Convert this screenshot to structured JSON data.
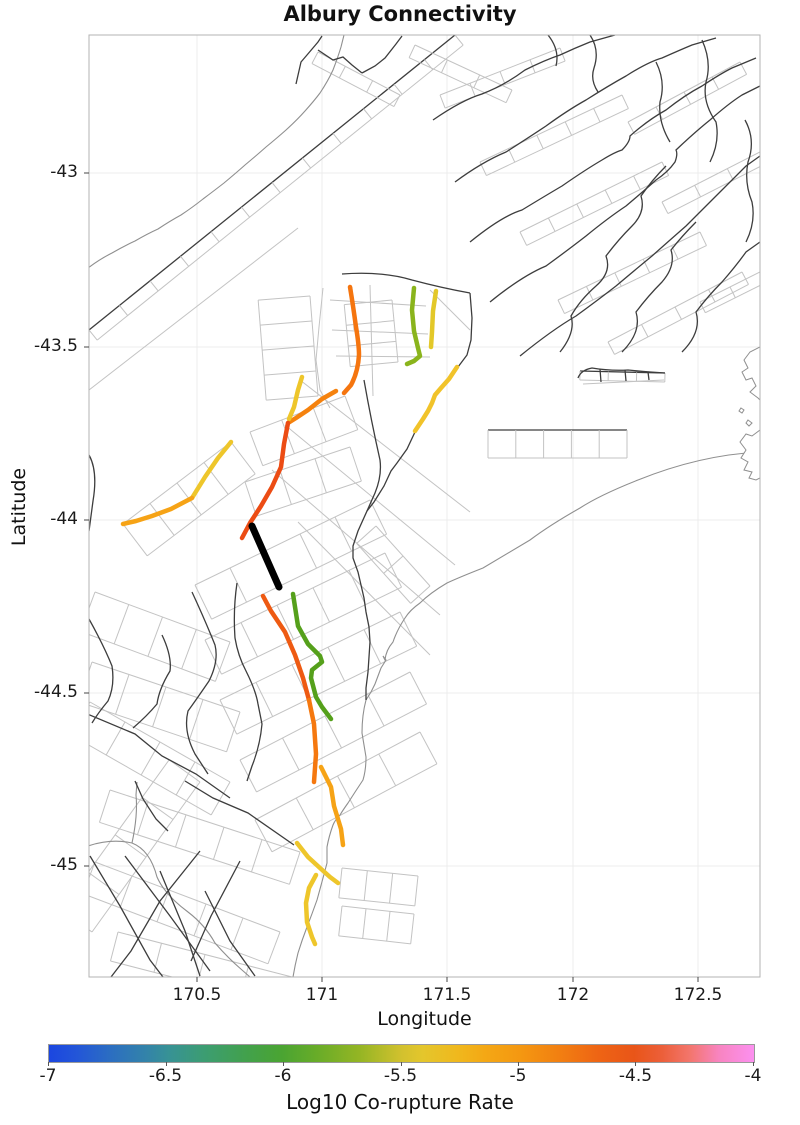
{
  "title": "Albury Connectivity",
  "axes": {
    "xlabel": "Longitude",
    "ylabel": "Latitude",
    "x_ticks": [
      {
        "label": "170.5",
        "px": 197
      },
      {
        "label": "171",
        "px": 322
      },
      {
        "label": "171.5",
        "px": 447
      },
      {
        "label": "172",
        "px": 573
      },
      {
        "label": "172.5",
        "px": 698
      }
    ],
    "y_ticks": [
      {
        "label": "-43",
        "px": 173
      },
      {
        "label": "-43.5",
        "px": 347
      },
      {
        "label": "-44",
        "px": 520
      },
      {
        "label": "-44.5",
        "px": 693
      },
      {
        "label": "-45",
        "px": 866
      }
    ],
    "plot_rect": {
      "x": 89,
      "y": 35,
      "w": 671,
      "h": 942
    }
  },
  "colorbar": {
    "label": "Log10 Co-rupture Rate",
    "min": -7,
    "max": -4,
    "ticks": [
      {
        "label": "-7",
        "frac": 0
      },
      {
        "label": "-6.5",
        "frac": 0.1667
      },
      {
        "label": "-6",
        "frac": 0.3333
      },
      {
        "label": "-5.5",
        "frac": 0.5
      },
      {
        "label": "-5",
        "frac": 0.6667
      },
      {
        "label": "-4.5",
        "frac": 0.8333
      },
      {
        "label": "-4",
        "frac": 1
      }
    ],
    "stops": [
      [
        "0%",
        "#1b46e0"
      ],
      [
        "4%",
        "#2356d8"
      ],
      [
        "9%",
        "#2c6fc0"
      ],
      [
        "14%",
        "#3384a8"
      ],
      [
        "17%",
        "#379295"
      ],
      [
        "22%",
        "#3c9d72"
      ],
      [
        "28%",
        "#42a14c"
      ],
      [
        "33%",
        "#4aa432"
      ],
      [
        "38%",
        "#68ac28"
      ],
      [
        "44%",
        "#94b524"
      ],
      [
        "50%",
        "#d2c12e"
      ],
      [
        "53%",
        "#e4c62c"
      ],
      [
        "58%",
        "#f0b81d"
      ],
      [
        "62%",
        "#f4a714"
      ],
      [
        "67%",
        "#f49711"
      ],
      [
        "72%",
        "#f28111"
      ],
      [
        "78%",
        "#ee6414"
      ],
      [
        "83%",
        "#e95518"
      ],
      [
        "87%",
        "#ec5f3a"
      ],
      [
        "91%",
        "#f3766e"
      ],
      [
        "95%",
        "#f884c0"
      ],
      [
        "100%",
        "#fc90f0"
      ]
    ]
  },
  "chart_data": {
    "type": "line",
    "subtype": "geographic fault-network map",
    "title": "Albury Connectivity",
    "xlabel": "Longitude",
    "ylabel": "Latitude",
    "xlim": [
      170.07,
      172.74
    ],
    "ylim": [
      -45.31,
      -42.6
    ],
    "x_ticks": [
      170.5,
      171,
      171.5,
      172,
      172.5
    ],
    "y_ticks": [
      -43,
      -43.5,
      -44,
      -44.5,
      -45
    ],
    "grid": true,
    "colorbar": {
      "label": "Log10 Co-rupture Rate",
      "range": [
        -7,
        -4
      ],
      "ticks": [
        -7,
        -6.5,
        -6,
        -5.5,
        -5,
        -4.5,
        -4
      ]
    },
    "legend_position": "bottom",
    "background_layers": [
      "grey fault surface-projection polygons",
      "dark fault traces",
      "coastline"
    ],
    "highlighted_faults": [
      {
        "segment": "north-central trace",
        "color": "#f5750f",
        "log10_rate": -4.8
      },
      {
        "segment": "northwest yellow branch",
        "color": "#eec62b",
        "log10_rate": -5.5
      },
      {
        "segment": "west arc yellow part",
        "color": "#eec62b",
        "log10_rate": -5.5
      },
      {
        "segment": "west arc amber part",
        "color": "#f6a316",
        "log10_rate": -5.2
      },
      {
        "segment": "central red-orange trace",
        "color": "#ec4c14",
        "log10_rate": -4.5
      },
      {
        "segment": "upper green branch",
        "color": "#8ab41c",
        "log10_rate": -5.9
      },
      {
        "segment": "upper yellow branch",
        "color": "#e3c829",
        "log10_rate": -5.6
      },
      {
        "segment": "east yellow branch",
        "color": "#f1c32a",
        "log10_rate": -5.4
      },
      {
        "segment": "source fault (thick black)",
        "color": "#000000",
        "log10_rate": null
      },
      {
        "segment": "lower red-orange trace",
        "color": "#ee5a12",
        "log10_rate": -4.7
      },
      {
        "segment": "lower orange trace",
        "color": "#f5780f",
        "log10_rate": -4.9
      },
      {
        "segment": "lower amber trace",
        "color": "#f6a316",
        "log10_rate": -5.2
      },
      {
        "segment": "lower green zigzag",
        "color": "#55a01b",
        "log10_rate": -6.0
      },
      {
        "segment": "south yellow segments",
        "color": "#eec62b",
        "log10_rate": -5.5
      }
    ]
  },
  "map_layers": {
    "ladders": [
      {
        "x1": 89,
        "y1": 330,
        "x2": 455,
        "y2": 35,
        "w": 13,
        "n": 12,
        "main": "dark"
      },
      {
        "x1": 318,
        "y1": 52,
        "x2": 400,
        "y2": 95,
        "w": 13,
        "n": 3,
        "main": "gray"
      },
      {
        "x1": 415,
        "y1": 45,
        "x2": 512,
        "y2": 90,
        "w": 14,
        "n": 3,
        "main": "gray"
      },
      {
        "x1": 440,
        "y1": 95,
        "x2": 560,
        "y2": 48,
        "w": 14,
        "n": 4,
        "main": "gray"
      },
      {
        "x1": 480,
        "y1": 162,
        "x2": 622,
        "y2": 95,
        "w": 15,
        "n": 5,
        "main": "gray"
      },
      {
        "x1": 520,
        "y1": 232,
        "x2": 662,
        "y2": 162,
        "w": 15,
        "n": 5,
        "main": "gray"
      },
      {
        "x1": 558,
        "y1": 300,
        "x2": 700,
        "y2": 232,
        "w": 15,
        "n": 5,
        "main": "gray"
      },
      {
        "x1": 608,
        "y1": 342,
        "x2": 742,
        "y2": 272,
        "w": 14,
        "n": 4,
        "main": "gray"
      },
      {
        "x1": 628,
        "y1": 122,
        "x2": 740,
        "y2": 62,
        "w": 14,
        "n": 4,
        "main": "gray"
      },
      {
        "x1": 662,
        "y1": 202,
        "x2": 760,
        "y2": 152,
        "w": 13,
        "n": 3,
        "main": "gray"
      },
      {
        "x1": 700,
        "y1": 302,
        "x2": 760,
        "y2": 272,
        "w": 12,
        "n": 2,
        "main": "gray"
      },
      {
        "x1": 488,
        "y1": 430,
        "x2": 627,
        "y2": 430,
        "w": 28,
        "n": 5,
        "main": "dark"
      },
      {
        "x1": 580,
        "y1": 371,
        "x2": 665,
        "y2": 373,
        "w": 9,
        "n": 3,
        "main": "dark"
      },
      {
        "x1": 195,
        "y1": 585,
        "x2": 370,
        "y2": 500,
        "w": 38,
        "n": 5,
        "main": "gray"
      },
      {
        "x1": 205,
        "y1": 640,
        "x2": 385,
        "y2": 553,
        "w": 38,
        "n": 5,
        "main": "gray"
      },
      {
        "x1": 220,
        "y1": 700,
        "x2": 400,
        "y2": 612,
        "w": 38,
        "n": 5,
        "main": "gray"
      },
      {
        "x1": 240,
        "y1": 760,
        "x2": 410,
        "y2": 672,
        "w": 36,
        "n": 4,
        "main": "gray"
      },
      {
        "x1": 255,
        "y1": 820,
        "x2": 420,
        "y2": 732,
        "w": 36,
        "n": 4,
        "main": "gray"
      },
      {
        "x1": 250,
        "y1": 432,
        "x2": 345,
        "y2": 396,
        "w": 36,
        "n": 3,
        "main": "gray"
      },
      {
        "x1": 245,
        "y1": 482,
        "x2": 350,
        "y2": 447,
        "w": 36,
        "n": 3,
        "main": "gray"
      },
      {
        "x1": 95,
        "y1": 592,
        "x2": 230,
        "y2": 642,
        "w": 42,
        "n": 4,
        "main": "gray"
      },
      {
        "x1": 92,
        "y1": 662,
        "x2": 240,
        "y2": 712,
        "w": 42,
        "n": 4,
        "main": "gray"
      },
      {
        "x1": 110,
        "y1": 790,
        "x2": 300,
        "y2": 852,
        "w": 34,
        "n": 5,
        "main": "gray"
      },
      {
        "x1": 95,
        "y1": 862,
        "x2": 280,
        "y2": 932,
        "w": 34,
        "n": 5,
        "main": "gray"
      },
      {
        "x1": 118,
        "y1": 932,
        "x2": 292,
        "y2": 977,
        "w": 30,
        "n": 4,
        "main": "gray"
      },
      {
        "x1": 90,
        "y1": 702,
        "x2": 230,
        "y2": 782,
        "w": 38,
        "n": 4,
        "main": "gray"
      },
      {
        "x1": 200,
        "y1": 782,
        "x2": 92,
        "y2": 932,
        "w": 38,
        "n": 4,
        "main": "gray"
      },
      {
        "x1": 123,
        "y1": 524,
        "x2": 231,
        "y2": 442,
        "w": 40,
        "n": 4,
        "main": "gray"
      },
      {
        "x1": 310,
        "y1": 296,
        "x2": 318,
        "y2": 396,
        "w": 52,
        "n": 4,
        "main": "gray"
      },
      {
        "x1": 392,
        "y1": 300,
        "x2": 398,
        "y2": 362,
        "w": 48,
        "n": 3,
        "main": "gray"
      },
      {
        "x1": 376,
        "y1": 526,
        "x2": 430,
        "y2": 586,
        "w": 26,
        "n": 2,
        "main": "gray"
      },
      {
        "x1": 342,
        "y1": 868,
        "x2": 418,
        "y2": 876,
        "w": 30,
        "n": 3,
        "main": "gray"
      },
      {
        "x1": 342,
        "y1": 906,
        "x2": 414,
        "y2": 914,
        "w": 30,
        "n": 3,
        "main": "gray"
      }
    ],
    "gray_paths": [
      "M323,288 L319,327 316,360 320,390 330,408",
      "M330,300 L426,306",
      "M332,330 L428,334",
      "M336,356 L430,357",
      "M370,285 L373,396",
      "M352,287 L354,330",
      "M300,380 L470,512",
      "M285,425 L455,565",
      "M272,470 L440,615",
      "M298,522 L430,655",
      "M89,390 L298,228",
      "M430,290 L470,330",
      "M583,384 L664,380"
    ],
    "coast_paths": [
      "M760,452 Q700,455 638,480 Q600,495 580,508 Q550,525 530,540 Q505,555 483,568 Q460,577 447,583 Q430,593 420,603 Q410,610 405,618 Q397,630 393,642 Q386,650 385,660 L383,656 386,660 381,668 378,676 375,684 371,692 366,700 Q362,715 362,733 Q364,745 366,757 Q366,770 363,780 Q355,792 348,803 Q343,810 340,815 Q335,820 333,825 Q329,836 327,847 Q327,855 327,863 Q322,882 317,900 Q312,914 307,927 Q302,940 298,953 Q295,965 293,977",
      "M88,268 Q100,259 112,253 Q124,246 135,241 Q147,234 158,229 Q170,221 181,215 Q193,207 203,199 Q215,190 224,183 Q236,173 245,165 Q257,155 266,147 Q277,138 286,130 Q297,120 305,111 Q314,101 320,93 Q328,81 333,70 Q338,57 341,47 L344,35",
      "M85,847 Q110,838 132,843 Q150,850 157,877 Q165,895 188,912 Q205,925 215,943 Q228,958 242,970 L250,977",
      "M132,843 Q138,815 136,795 L137,782"
    ],
    "peninsulas": [
      "M760,347 L750,352 744,360 748,368 742,372 746,380 752,378 756,386 750,392 758,398 760,400",
      "M760,430 L752,436 746,434 740,442 746,450 741,458 748,462 744,470 752,472 749,478 756,480 760,478",
      "M741,408 l3,2 -2,3 -3,-2 z",
      "M748,420 l4,3 -3,3 -3,-3 z"
    ],
    "dark_paths": [
      "M296,84 L301,62 307,55 318,42 322,36",
      "M318,50 L333,60 343,57 352,65 362,73",
      "M362,73 L375,66 385,58 396,44 402,36",
      "M433,120 Q462,100 482,94 Q505,85 525,70 Q545,60 560,55 Q575,48 590,42 L615,35",
      "M455,182 Q482,162 506,152 Q528,138 546,126 Q568,110 586,100 Q608,86 626,76 Q648,62 662,58 Q680,50 692,45 L716,38",
      "M470,242 Q502,216 522,210 Q545,196 562,186 Q585,170 602,160 Q615,152 622,150 Q630,142 630,136 Q648,120 666,110 Q685,95 702,86 Q720,74 732,68 L756,58",
      "M490,302 Q522,276 546,266 Q568,250 586,236 Q608,218 626,206 Q645,190 656,180 Q668,172 675,162 Q678,154 676,150 Q695,132 710,120 Q728,104 742,95 L760,86",
      "M520,356 Q552,330 576,316 Q598,300 616,286 Q635,270 652,256 Q670,240 686,226 Q702,210 716,196 Q732,180 746,166 L760,156",
      "M560,352 Q576,332 571,316 Q580,300 596,286 Q612,272 606,256 Q618,240 632,226 Q646,212 641,196 Q652,180 666,166",
      "M622,352 Q642,332 636,312 Q648,296 662,282 Q676,266 671,250 Q682,236 696,222",
      "M682,352 Q702,332 696,312 Q708,296 722,282 Q736,266 746,252 L760,242",
      "M745,120 Q756,140 748,162 Q744,182 752,202 Q756,222 746,242",
      "M702,40 Q712,62 706,82 Q702,102 716,122 Q720,142 710,162",
      "M656,62 Q666,82 660,102 Q658,122 670,142",
      "M548,35 Q560,50 556,66",
      "M590,35 Q600,50 594,68 Q590,80 598,92",
      "M342,274 Q382,271 412,280 Q442,288 470,293",
      "M470,293 L472,318 471,340 467,355 458,367",
      "M415,432 L407,449 397,463 391,471 384,486 379,494 374,502 367,511 358,531 353,546 353,558 358,572 361,585 364,598 366,612 369,627 370,642 369,657 368,672 366,688 366,700",
      "M364,380 Q371,420 380,460 Q382,476 375,493 L367,511",
      "M192,592 Q205,620 215,645 Q219,661 209,681 Q196,700 188,711 Q183,731 195,754 L208,774",
      "M237,583 Q233,610 235,638 Q238,656 246,671 Q256,691 258,704 L262,724 Q260,746 252,766 L247,781",
      "M162,635 Q172,656 170,671 Q159,689 157,704 Q147,716 133,728",
      "M85,713 L135,734 162,756 196,774 230,798",
      "M135,781 L143,799 156,819 168,831",
      "M185,781 L213,798 248,813 294,845",
      "M90,856 L120,906 150,960 163,977",
      "M125,856 L170,916 210,971",
      "M160,871 L185,931 200,976",
      "M205,891 L230,941 255,976",
      "M200,851 L160,901 131,951 111,977",
      "M240,861 L211,916 191,961",
      "M89,455 Q98,471 93,501 L89,531",
      "M89,619 Q104,646 112,666 Q115,686 108,701 Q98,713 92,723",
      "M578,378 Q581,370 592,368 Q610,371 628,370 Q648,372 665,373",
      "M600,369 L601,382 M625,370 L626,381 M648,372 L649,380"
    ],
    "colored_traces": [
      {
        "d": "M350,287 Q353,305 356,327 Q359,345 359,355 Q358,372 351,385 L344,393",
        "c": "#f5750f",
        "w": 4.5
      },
      {
        "d": "M336,391 L322,399 308,410 296,418 288,423",
        "c": "#f5820e",
        "w": 4.5
      },
      {
        "d": "M302,377 L298,390 294,407 289,419",
        "c": "#eec62b",
        "w": 4.5
      },
      {
        "d": "M288,423 L284,444 281,467 272,487 261,506 250,523 242,538",
        "c": "#ec4c14",
        "w": 4.5
      },
      {
        "d": "M231,442 L218,458 205,477 192,498",
        "c": "#eec62b",
        "w": 4.5
      },
      {
        "d": "M192,498 L171,509 152,516 136,521 123,524",
        "c": "#f6a316",
        "w": 4.5
      },
      {
        "d": "M414,288 L412,310 414,331 418,348 420,356 414,361 407,364",
        "c": "#8ab41c",
        "w": 4.5
      },
      {
        "d": "M436,291 L433,311 432,332 431,347",
        "c": "#e3c829",
        "w": 4.5
      },
      {
        "d": "M457,367 L449,379 441,388 435,395 432,403 428,411 423,419 415,431",
        "c": "#f1c32a",
        "w": 4.5
      },
      {
        "d": "M252,526 L279,587",
        "c": "#000000",
        "w": 7
      },
      {
        "d": "M263,596 L271,611 285,632 295,655 303,678 309,700",
        "c": "#ee5a12",
        "w": 4.5
      },
      {
        "d": "M309,700 L314,724 316,754 314,782",
        "c": "#f5780f",
        "w": 4.5
      },
      {
        "d": "M321,767 L331,787 334,806 341,829 343,845",
        "c": "#f6a316",
        "w": 4.5
      },
      {
        "d": "M293,594 L298,626 308,644 320,656 322,662 312,670 311,678 316,697 322,707 331,719",
        "c": "#55a01b",
        "w": 4.5
      },
      {
        "d": "M297,843 L308,857 320,868 330,877 338,883",
        "c": "#eec62b",
        "w": 4.5
      },
      {
        "d": "M316,875 L309,888 306,903 307,922 312,937 315,944",
        "c": "#eec62b",
        "w": 4.5
      }
    ],
    "colors": {
      "gray": "#c3c3c3",
      "dark": "#3d3d3d",
      "coast": "#8f8f8f",
      "grid": "#ececec",
      "frame": "#b3b3b3",
      "tick": "#444444"
    }
  }
}
